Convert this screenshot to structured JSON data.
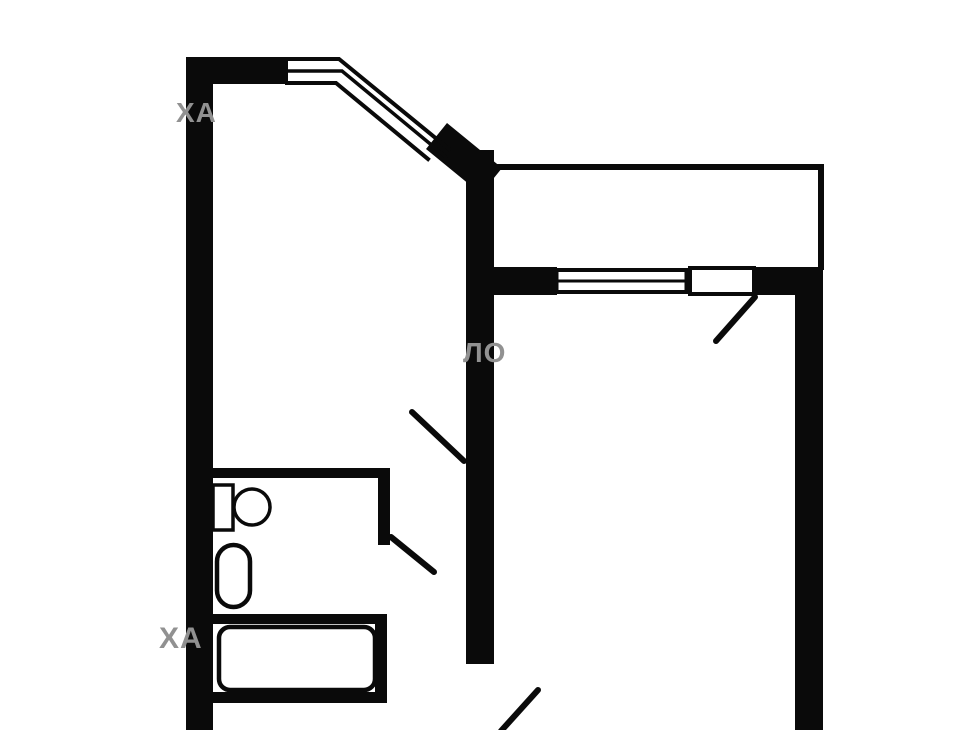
{
  "title": "apartment-floor-plan",
  "colors": {
    "background": "#ffffff",
    "wall": "#0a0a0a",
    "fixture_fill": "#ffffff",
    "watermark": "#919191"
  },
  "watermarks": {
    "top_left": "ХА",
    "center": "ЛО",
    "bottom_left": "ХА"
  }
}
